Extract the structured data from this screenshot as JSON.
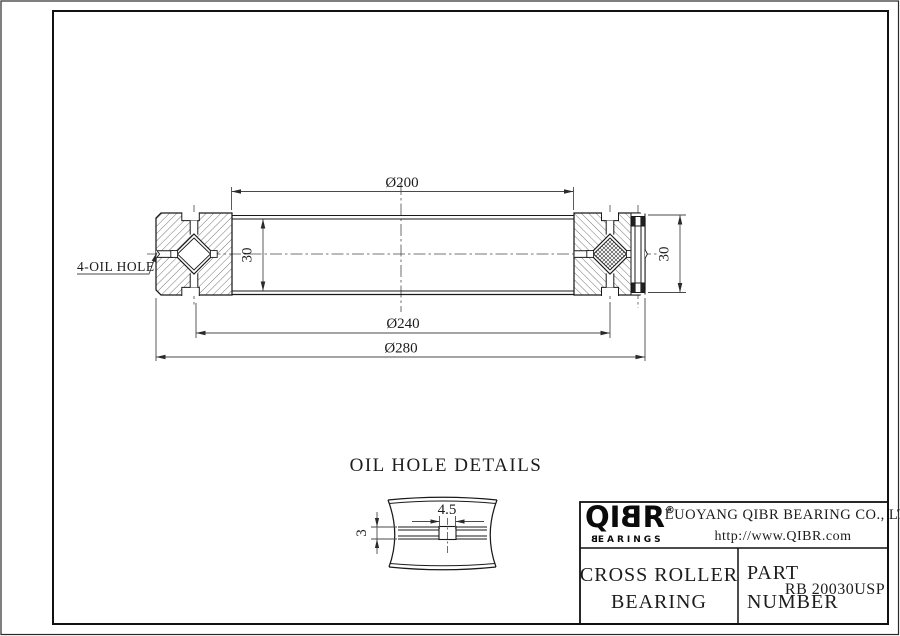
{
  "drawing": {
    "callout": "4-OIL HOLE",
    "dim_bore": "Ø200",
    "dim_pitch": "Ø240",
    "dim_outer": "Ø280",
    "dim_width_left": "30",
    "dim_width_right": "30"
  },
  "detail": {
    "title": "OIL HOLE DETAILS",
    "dim_hole_dia": "4.5",
    "dim_hole_depth": "3"
  },
  "title_block": {
    "logo": {
      "letters": [
        "Q",
        "I",
        "B",
        "R"
      ],
      "registered": "®",
      "subtitle_first": "B",
      "subtitle_rest": "EARINGS"
    },
    "company_name": "LUOYANG QIBR BEARING CO., LTD",
    "company_url": "http://www.QIBR.com",
    "product_line1": "CROSS ROLLER",
    "product_line2": "BEARING",
    "part_label_line1": "PART",
    "part_label_line2": "NUMBER",
    "part_number": "RB 20030USP"
  }
}
